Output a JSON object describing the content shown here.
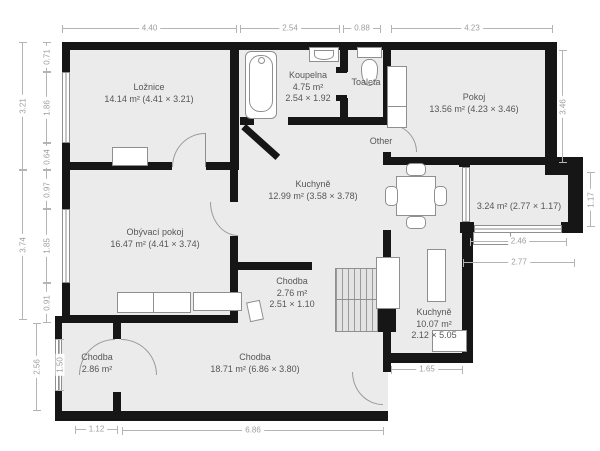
{
  "plan_type": "apartment-floor-plan",
  "colors": {
    "wall": "#161616",
    "room_fill": "#ebebeb",
    "dim_line": "#b4b4b4",
    "dim_text": "#9e9e9e",
    "label_text": "#565656",
    "background": "#ffffff"
  },
  "rooms": [
    {
      "name": "Ložnice",
      "area_line": "14.14 m² (4.41 × 3.21)"
    },
    {
      "name": "Koupelna",
      "area_line": "4.75 m²",
      "dims_line": "2.54 × 1.92"
    },
    {
      "name": "Toaleta"
    },
    {
      "name": "Pokoj",
      "area_line": "13.56 m² (4.23 × 3.46)"
    },
    {
      "name": "Kuchyně",
      "area_line": "12.99 m² (3.58 × 3.78)"
    },
    {
      "name": "Obývací pokoj",
      "area_line": "16.47 m² (4.41 × 3.74)"
    },
    {
      "name": "Chodba",
      "area_line": "2.76 m²",
      "dims_line": "2.51 × 1.10"
    },
    {
      "name": "Kuchyně",
      "area_line": "10.07 m²",
      "dims_line": "2.12 × 5.05"
    },
    {
      "name": "Chodba",
      "area_line": "18.71 m² (6.86 × 3.80)"
    },
    {
      "name": "Chodba",
      "area_line": "2.86 m²"
    },
    {
      "name": "",
      "area_line": "3.24 m² (2.77 × 1.17)"
    },
    {
      "name": "Other"
    }
  ],
  "dims_top": [
    "4.40",
    "2.54",
    "0.88",
    "4.23"
  ],
  "dims_left": [
    "3.21",
    "0.71",
    "1.86",
    "0.64",
    "3.74",
    "0.97",
    "1.85",
    "0.91",
    "2.56",
    "1.50"
  ],
  "dims_right": [
    "3.46",
    "1.17"
  ],
  "dims_balcony": [
    "2.46",
    "2.77"
  ],
  "dims_bottom": [
    "1.12",
    "6.86",
    "1.65"
  ],
  "furniture": [
    "bathtub",
    "sink",
    "toilet",
    "wardrobe",
    "dresser",
    "sofa",
    "dining-table",
    "chair",
    "fridge",
    "kitchen-island",
    "counter",
    "closet",
    "window-sill",
    "door-leaf"
  ]
}
